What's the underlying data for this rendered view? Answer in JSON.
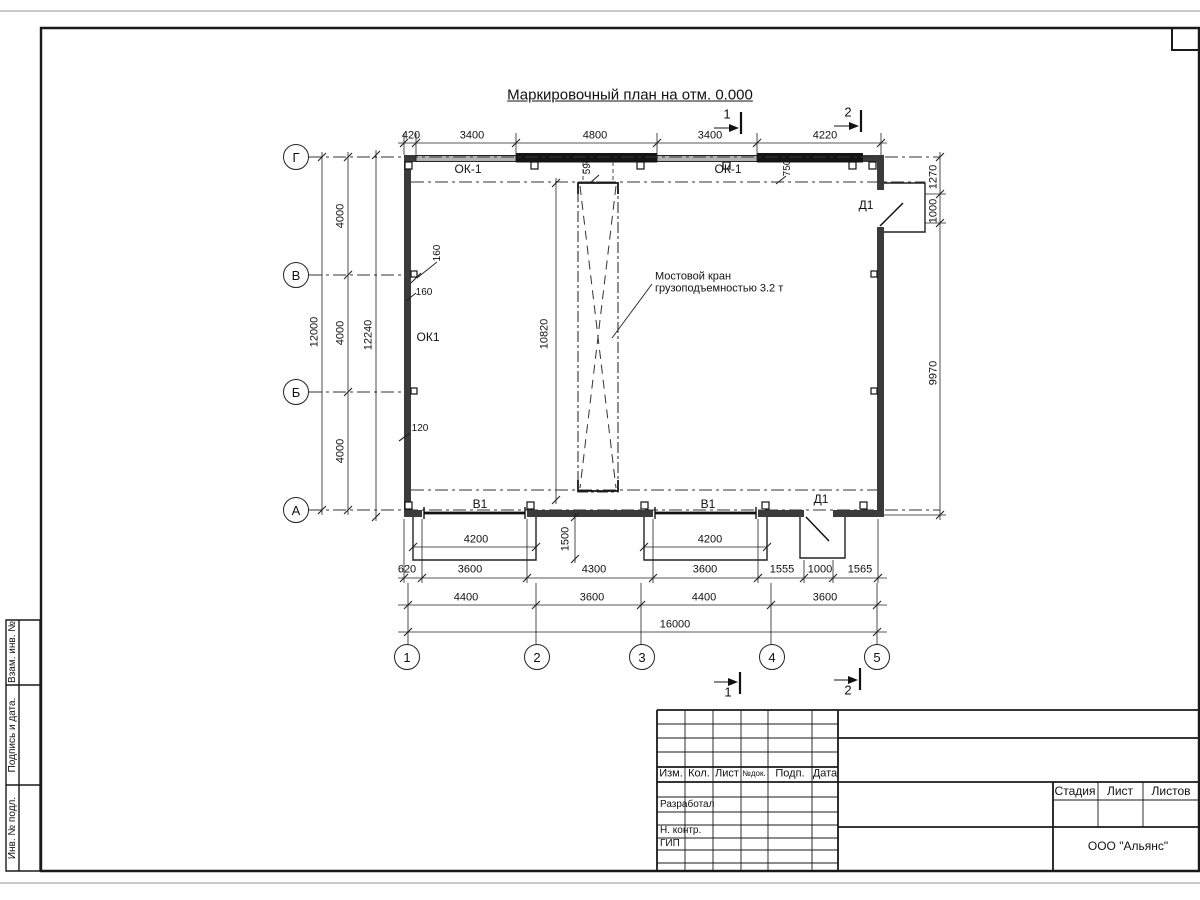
{
  "sheet": {
    "title": "Маркировочный план на отм. 0.000"
  },
  "axes": {
    "rows": [
      "Г",
      "В",
      "Б",
      "А"
    ],
    "cols": [
      "1",
      "2",
      "3",
      "4",
      "5"
    ]
  },
  "sections": {
    "s1": "1",
    "s2": "2"
  },
  "dims": {
    "top": [
      "420",
      "3400",
      "4800",
      "3400",
      "4220"
    ],
    "left_total": "12000",
    "left_segs": [
      "4000",
      "4000",
      "4000"
    ],
    "left_outer": "12240",
    "right": [
      "1270",
      "1000",
      "9970"
    ],
    "crane_len": "10820",
    "crane_off": "590",
    "wall_off": "750",
    "wall_160a": "160",
    "wall_160b": "160",
    "wall_120": "120",
    "gate_w": [
      "4200",
      "4200"
    ],
    "gate_d": "1500",
    "bottom1": [
      "620",
      "3600",
      "4300",
      "3600",
      "1555",
      "1000",
      "1565"
    ],
    "bottom2": [
      "4400",
      "3600",
      "4400",
      "3600"
    ],
    "bottom_total": "16000"
  },
  "marks": {
    "ok1a": "ОК-1",
    "ok1b": "ОК-1",
    "ok1w": "ОК1",
    "d1a": "Д1",
    "d1b": "Д1",
    "v1a": "В1",
    "v1b": "В1"
  },
  "note": {
    "line1": "Мостовой кран",
    "line2": "грузоподъемностью 3.2 т"
  },
  "title_block": {
    "cols": [
      "Изм.",
      "Кол.",
      "Лист",
      "№док.",
      "Подп.",
      "Дата"
    ],
    "roles": [
      "Разработал",
      "Н. контр.",
      "ГИП"
    ],
    "stage": [
      "Стадия",
      "Лист",
      "Листов"
    ],
    "company": "ООО \"Альянс\""
  },
  "strip": [
    "Взам. инв. №",
    "Подпись и дата.",
    "Инв. № подл."
  ]
}
